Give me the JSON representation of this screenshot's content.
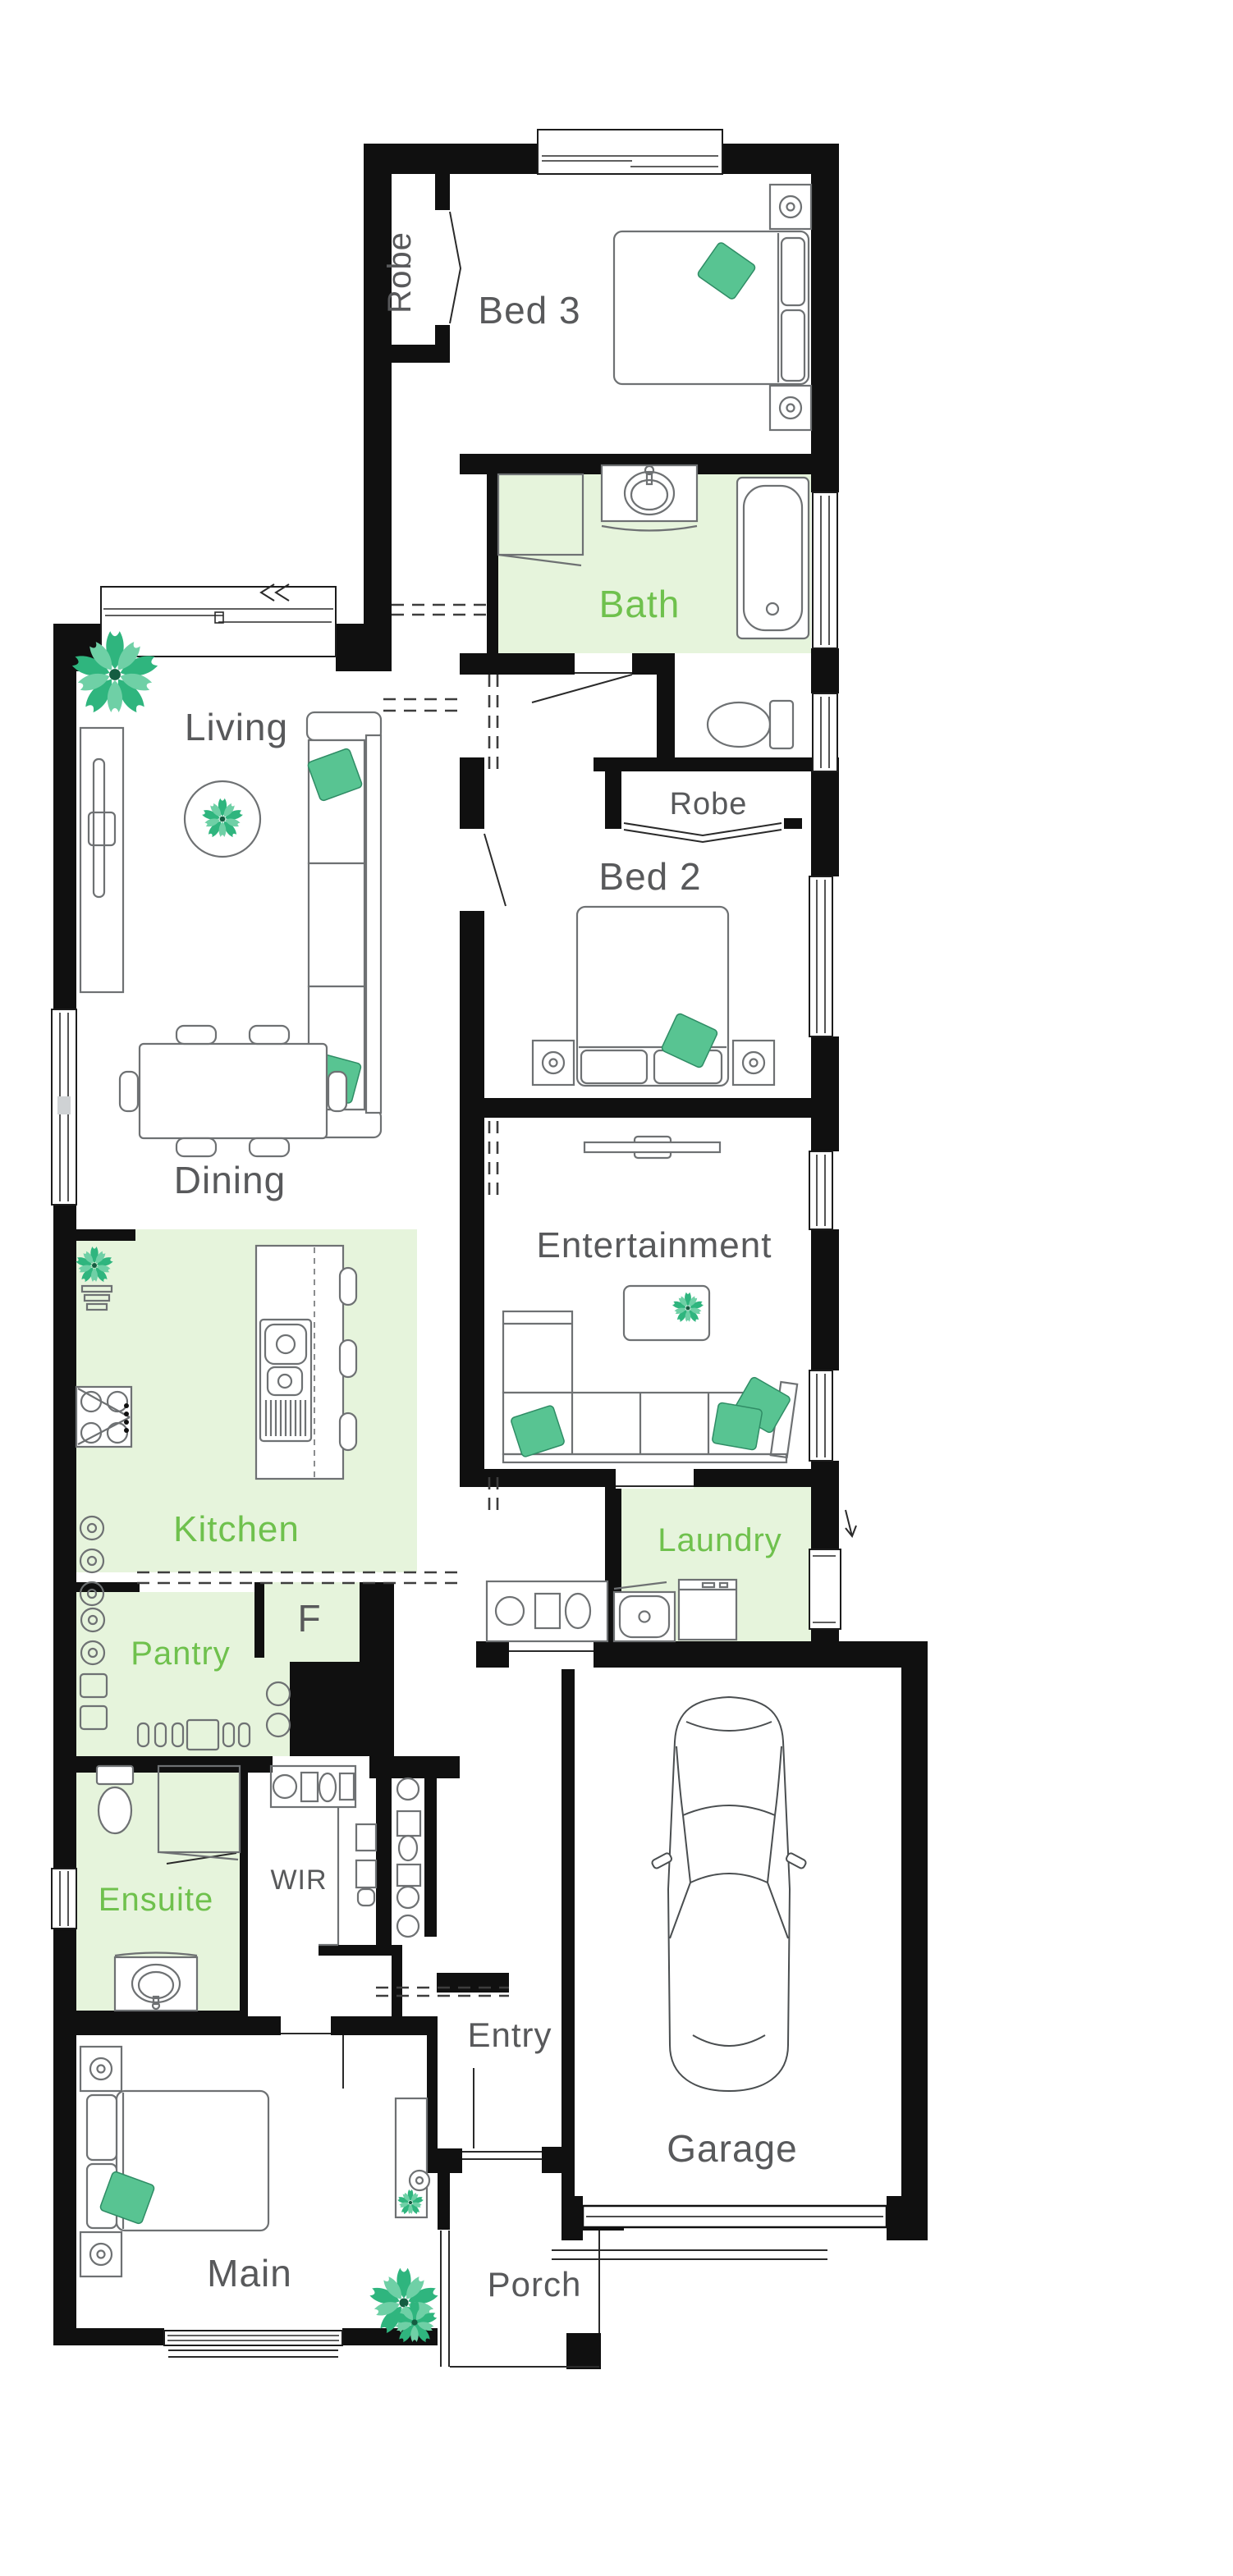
{
  "title": "Single storey home floor plan",
  "palette": {
    "wall": "#101010",
    "room_highlight": "#E6F4DC",
    "label_gray": "#58595B",
    "label_green": "#6FC14D",
    "accent_teal": "#58C492",
    "plant_green": "#2FB57E",
    "furniture_stroke": "#6E7173"
  },
  "rooms": {
    "bed3": {
      "label": "Bed 3"
    },
    "robe3": {
      "label": "Robe"
    },
    "bath": {
      "label": "Bath"
    },
    "living": {
      "label": "Living"
    },
    "robe2": {
      "label": "Robe"
    },
    "bed2": {
      "label": "Bed 2"
    },
    "dining": {
      "label": "Dining"
    },
    "entertainment": {
      "label": "Entertainment"
    },
    "kitchen": {
      "label": "Kitchen"
    },
    "laundry": {
      "label": "Laundry"
    },
    "pantry": {
      "label": "Pantry"
    },
    "fridge": {
      "label": "F"
    },
    "ensuite": {
      "label": "Ensuite"
    },
    "wir": {
      "label": "WIR"
    },
    "entry": {
      "label": "Entry"
    },
    "garage": {
      "label": "Garage"
    },
    "main": {
      "label": "Main"
    },
    "porch": {
      "label": "Porch"
    }
  },
  "icons": [
    "double-bed-icon",
    "queen-bed-icon",
    "sofa-icon",
    "l-sofa-icon",
    "tv-icon",
    "tv-unit-icon",
    "dining-table-icon",
    "kitchen-island-icon",
    "double-sink-icon",
    "cooktop-icon",
    "bathtub-icon",
    "shower-icon",
    "vanity-basin-icon",
    "toilet-icon",
    "laundry-tub-icon",
    "washing-machine-icon",
    "fridge-space-icon",
    "car-icon",
    "garage-door-icon",
    "plant-icon",
    "cushion-icon",
    "wardrobe-shelves-icon"
  ]
}
